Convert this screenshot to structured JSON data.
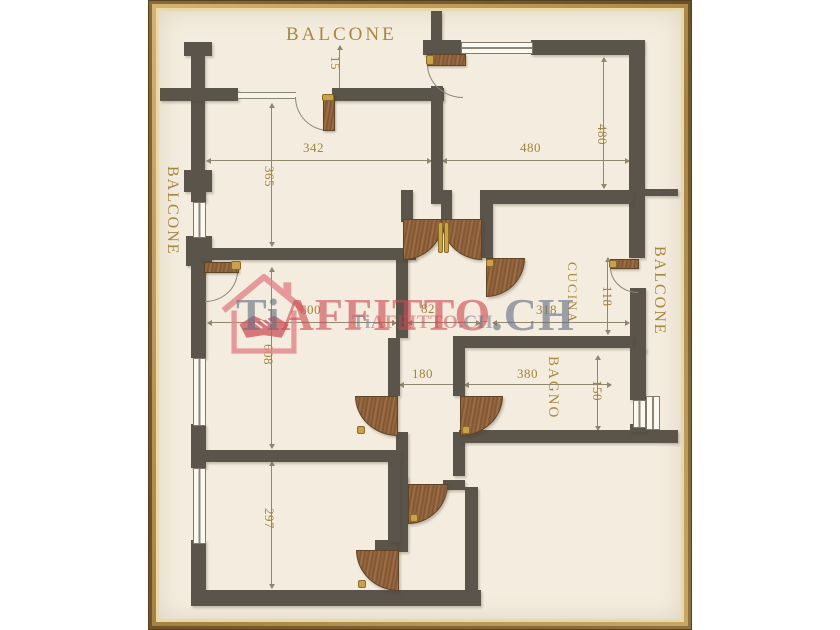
{
  "rooms": {
    "balcone_top": "BALCONE",
    "balcone_left": "BALCONE",
    "balcone_right": "BALCONE",
    "cucina": "CUCINA",
    "bagno": "BAGNO"
  },
  "dimensions": {
    "d15": "15",
    "d342": "342",
    "d365": "365",
    "d480h": "480",
    "d480v": "480",
    "d600": "600",
    "d82": "82",
    "d318": "318",
    "d608": "608",
    "d118": "118",
    "d180": "180",
    "d380": "380",
    "d150": "150",
    "d297": "297"
  },
  "watermark": {
    "prefix": "Ti",
    "middle": "AFFITTO",
    "suffix": ".CH"
  },
  "colors": {
    "wall": "#5a544b",
    "plan_background": "#f4eddf",
    "gold_text": "#a8873f",
    "frame_gold": "#c9a767",
    "wood_door": "#8a5c38",
    "watermark_red": "#cd4b52",
    "watermark_gray": "#667083"
  }
}
